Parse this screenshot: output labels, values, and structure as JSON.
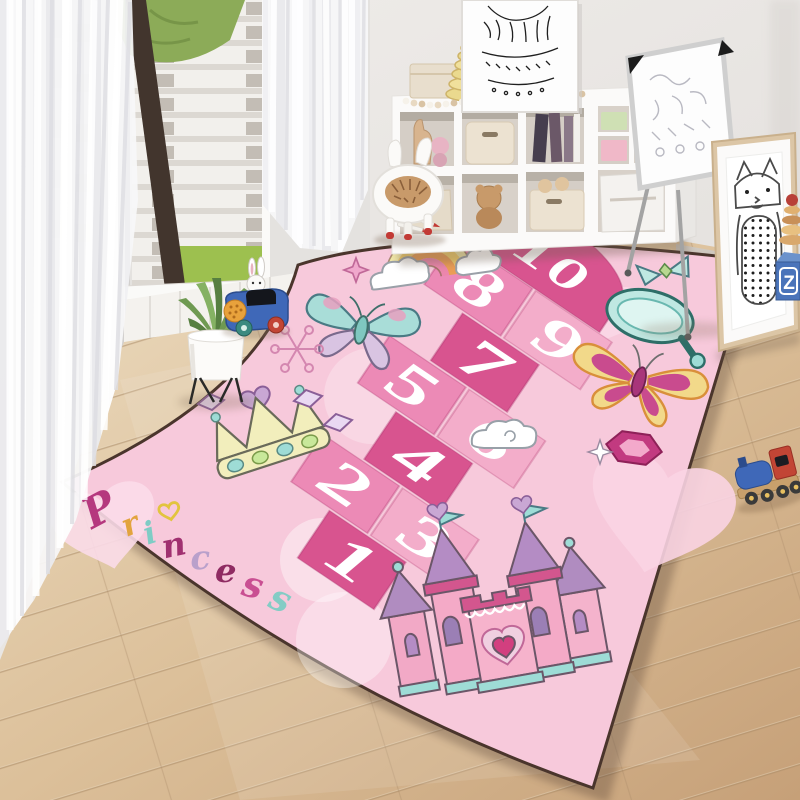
{
  "image_type": "kids-room lifestyle photo of a princess hopscotch play rug",
  "rug": {
    "base_color": "#f7c9db",
    "border_color": "#4a352c",
    "tile_colors": {
      "deep": "#d8548f",
      "medium": "#ec8ab6",
      "light": "#f3adca"
    },
    "hopscotch_tiles": [
      {
        "number": "10",
        "shade": "deep"
      },
      {
        "number": "8",
        "shade": "medium"
      },
      {
        "number": "9",
        "shade": "light"
      },
      {
        "number": "7",
        "shade": "deep"
      },
      {
        "number": "5",
        "shade": "medium"
      },
      {
        "number": "6",
        "shade": "light"
      },
      {
        "number": "4",
        "shade": "deep"
      },
      {
        "number": "2",
        "shade": "medium"
      },
      {
        "number": "3",
        "shade": "light"
      },
      {
        "number": "1",
        "shade": "deep"
      }
    ],
    "princess_word": {
      "word": "Princess",
      "letters": [
        {
          "char": "P",
          "color": "#b5387e"
        },
        {
          "char": "r",
          "color": "#e2a43e"
        },
        {
          "char": "i",
          "color": "#7fccc5"
        },
        {
          "char": "n",
          "color": "#a03070"
        },
        {
          "char": "c",
          "color": "#b9a0cb"
        },
        {
          "char": "e",
          "color": "#8f2b62"
        },
        {
          "char": "s",
          "color": "#c94f92"
        },
        {
          "char": "s",
          "color": "#84ccc5"
        }
      ]
    },
    "decorations": [
      "rainbow-with-sun",
      "clouds",
      "teal-butterfly",
      "yellow-butterfly",
      "small-teal-butterfly",
      "princess-crown",
      "diamond-gems",
      "heart-doodle",
      "snowflake-doodle",
      "pink-sparkle",
      "hand-mirror",
      "hexagon-gem",
      "white-sparkle",
      "princess-castle",
      "pale-hearts",
      "pale-circles"
    ]
  },
  "toys": {
    "letter_block": "Z"
  },
  "room_items": [
    "sheer-curtains",
    "window-city-view",
    "cube-storage-shelf",
    "stacking-ring-cone",
    "bead-garland",
    "doodle-art-frame",
    "whiteboard-easel",
    "cat-art-frame",
    "potted-plant",
    "bunny-toy-car",
    "animal-stool",
    "toy-train",
    "wood-floor"
  ]
}
